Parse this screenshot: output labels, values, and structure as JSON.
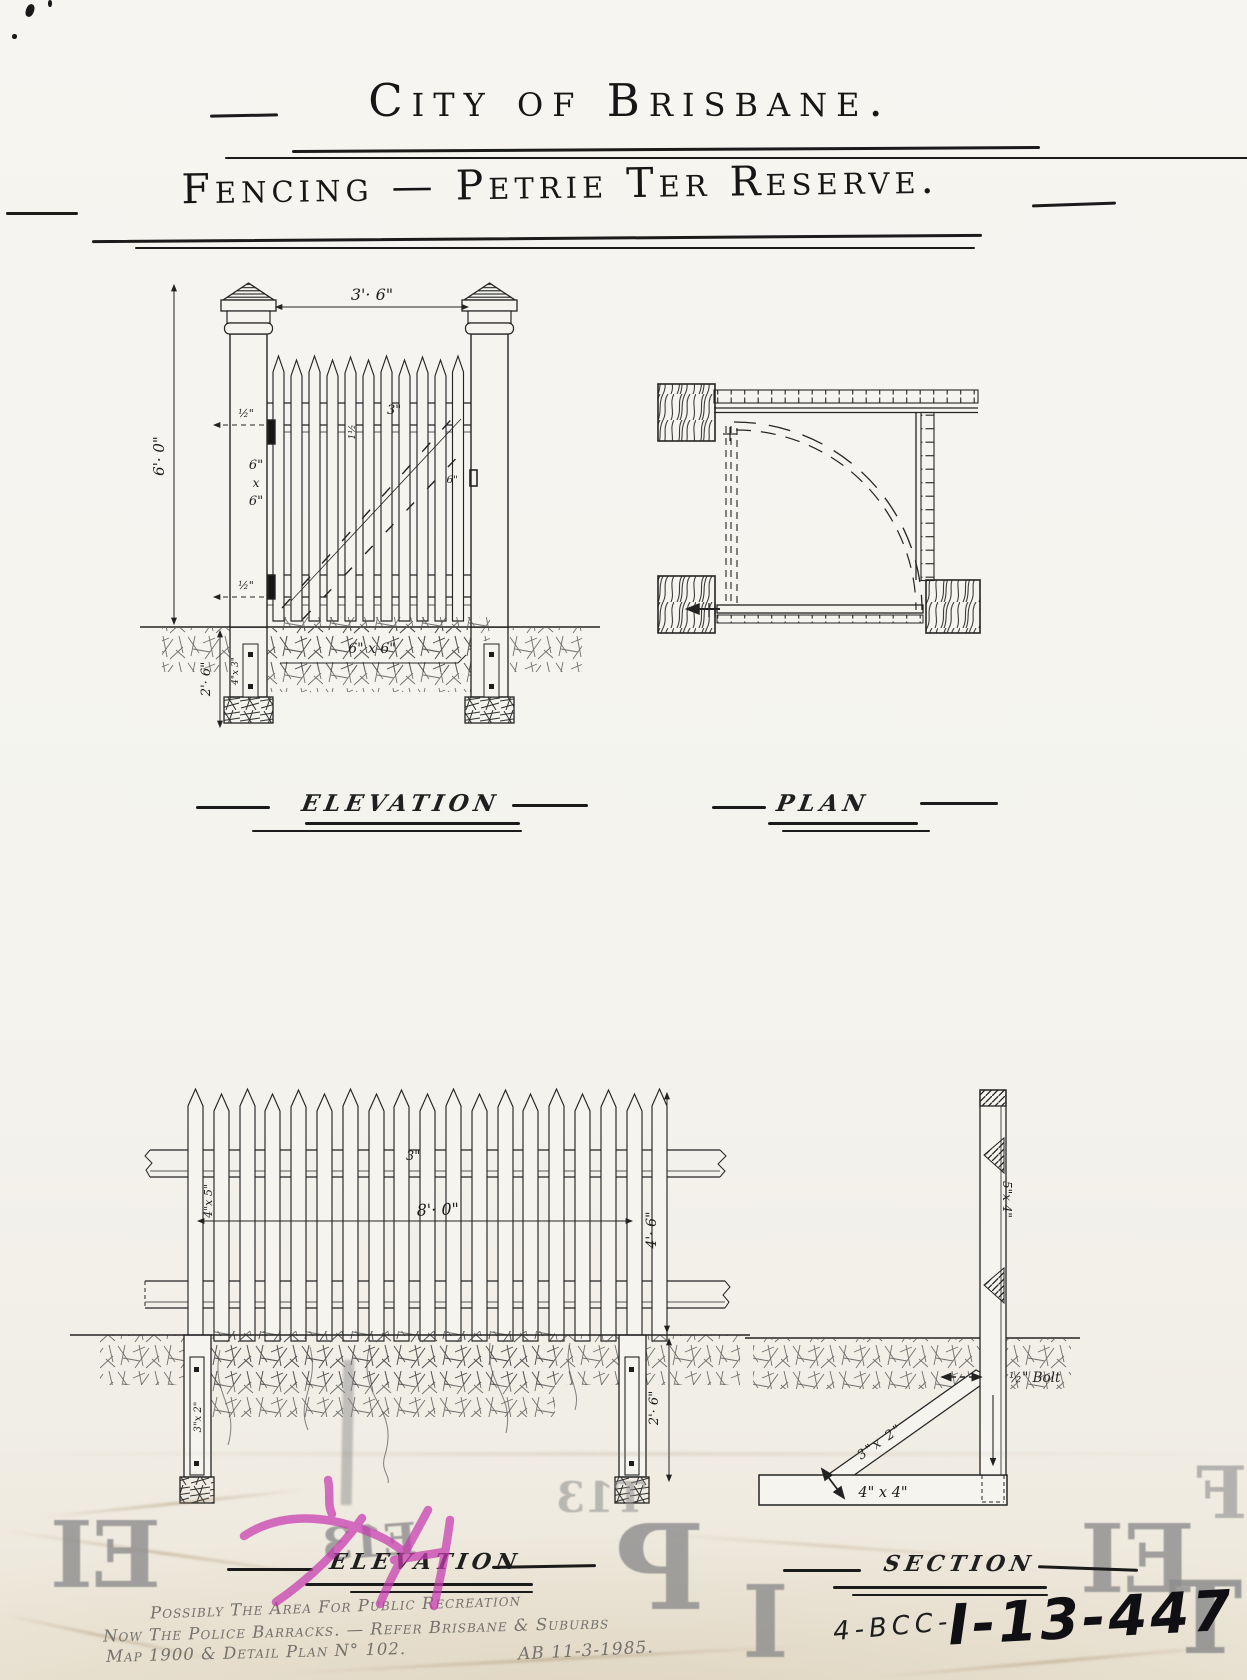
{
  "page": {
    "title1": "City of Brisbane.",
    "title2": "Fencing — Petrie Ter Reserve."
  },
  "labels": {
    "elevation_gate": "ELEVATION",
    "plan": "PLAN",
    "elevation_fence": "ELEVATION",
    "section": "SECTION"
  },
  "gate": {
    "width": "3'· 6\"",
    "height": "6'· 0\"",
    "post_w": "6\"",
    "post_x": "x",
    "post_h": "6\"",
    "rail_top_offset": "½\"",
    "rail_bottom_offset": "½\"",
    "picket_thickness": "1½",
    "picket_width": "3\"",
    "latch": "6\"",
    "depth": "2'· 6\"",
    "plinth": "6\" x 6\"",
    "batten": "4\"x 3\""
  },
  "fence": {
    "panel_width": "8'· 0\"",
    "height": "4'· 6\"",
    "depth": "2'· 6\"",
    "rail": "4\"x 5\"",
    "picket_width": "3\"",
    "batten": "3\"x 2\""
  },
  "section_view": {
    "post": "5\"x 4\"",
    "strut": "3\"x 2\"",
    "plate": "4\" x 4\"",
    "bolt": "½\" Bolt"
  },
  "note": {
    "line1": "Possibly The Area For Public Recreation",
    "line2": "Now The Police Barracks. — Refer Brisbane & Suburbs",
    "line3": "Map 1900  &  Detail Plan N° 102.",
    "signature": "AB 11-3-1985."
  },
  "number": {
    "prefix": "4-BCC-",
    "id": "I-13-447"
  },
  "stamp": {
    "g1": "EI",
    "g2": "E13",
    "g3": "T13",
    "g4": "P",
    "g5": "I",
    "g6": "EI",
    "g7": "F",
    "g8": "T"
  }
}
